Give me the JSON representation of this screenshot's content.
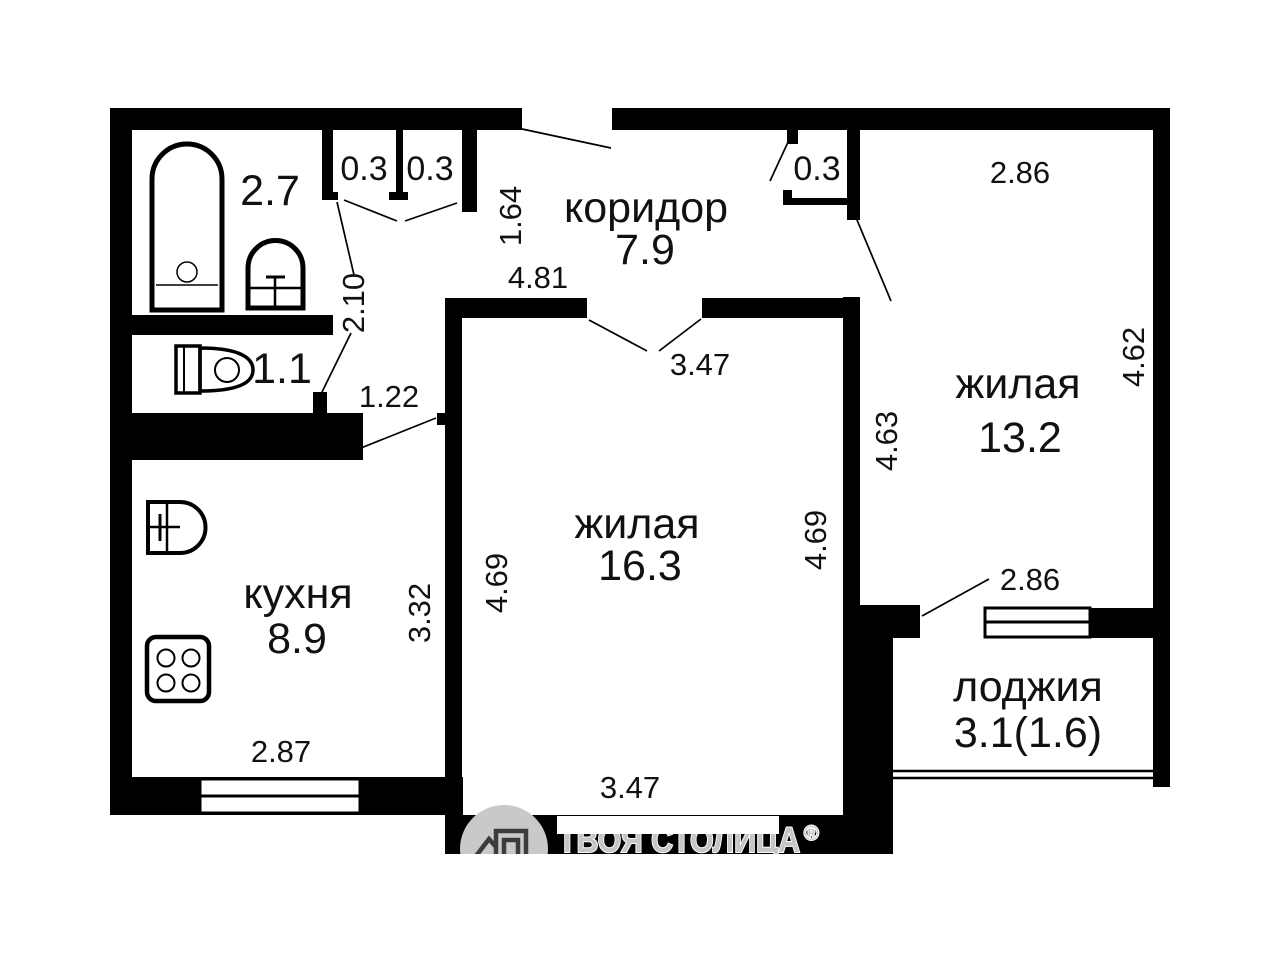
{
  "plan": {
    "corridor": {
      "name": "коридор",
      "area": "7.9"
    },
    "living_main": {
      "name": "жилая",
      "area": "16.3"
    },
    "living_second": {
      "name": "жилая",
      "area": "13.2"
    },
    "kitchen": {
      "name": "кухня",
      "area": "8.9"
    },
    "loggia": {
      "name": "лоджия",
      "area": "3.1(1.6)"
    },
    "bathroom": {
      "area": "2.7"
    },
    "toilet": {
      "area": "1.1"
    },
    "closet_left": {
      "area": "0.3"
    },
    "closet_middle": {
      "area": "0.3"
    },
    "closet_right": {
      "area": "0.3"
    }
  },
  "dims": {
    "entry_depth": "1.64",
    "corridor_width": "4.81",
    "living_door": "3.47",
    "bath_wall": "2.10",
    "kitchen_passage": "1.22",
    "living_left": "4.69",
    "living_right": "4.69",
    "living_width": "3.47",
    "kitchen_depth": "3.32",
    "kitchen_width": "2.87",
    "room2_width": "2.86",
    "room2_right": "4.62",
    "room2_left": "4.63",
    "loggia_width": "2.86"
  },
  "watermark": {
    "brand": "ТВОЯ СТОЛИЦА",
    "reg": "®"
  },
  "colors": {
    "wall": "#000000",
    "background": "#ffffff",
    "watermark_gray": "#c6c6c6"
  }
}
